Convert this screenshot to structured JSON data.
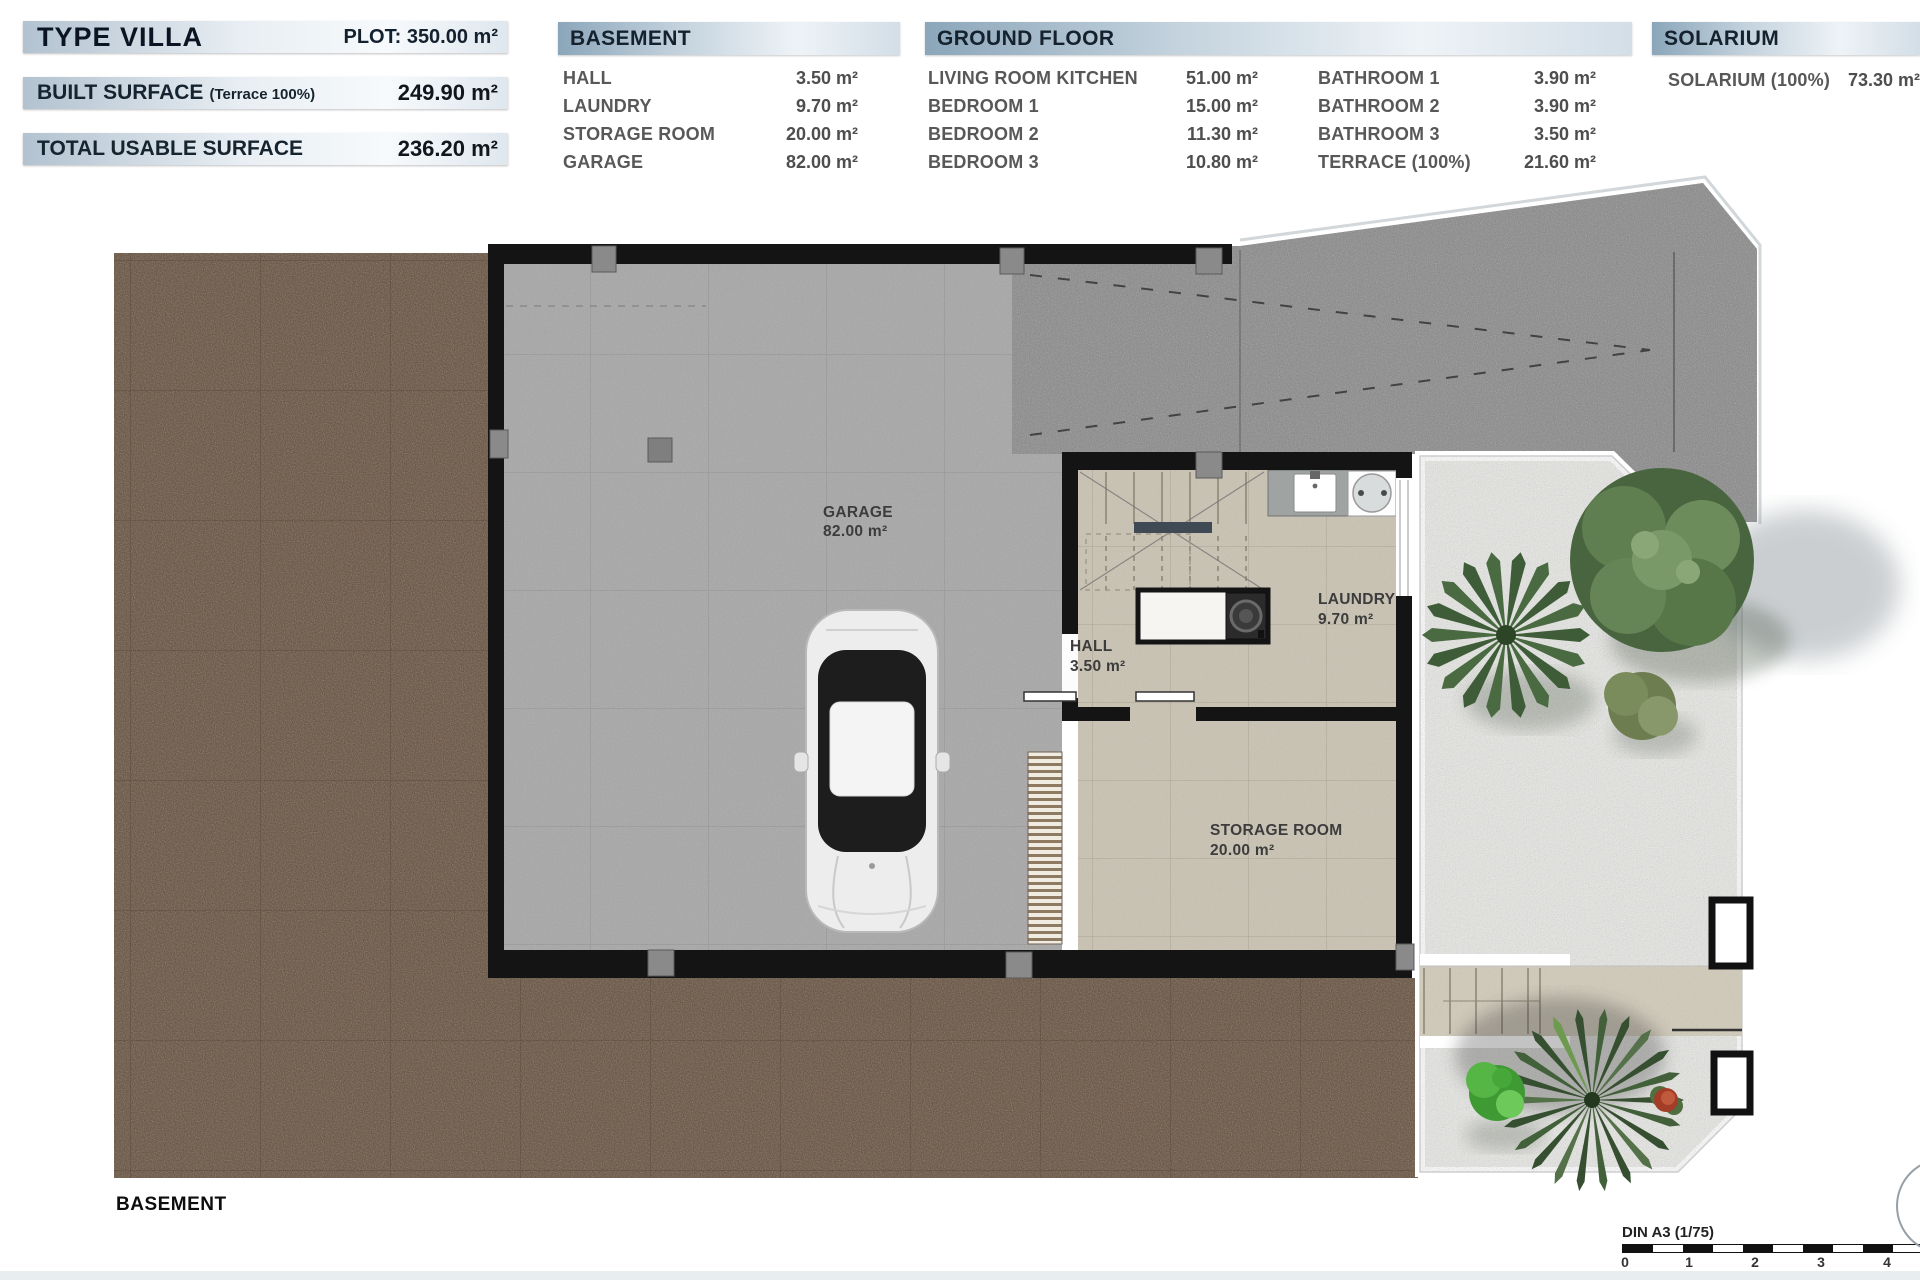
{
  "summary": {
    "type_label": "TYPE VILLA",
    "plot_label": "PLOT: 350.00 m²",
    "built_surface_label": "BUILT SURFACE",
    "built_surface_note": "(Terrace 100%)",
    "built_surface_value": "249.90 m²",
    "total_usable_label": "TOTAL USABLE SURFACE",
    "total_usable_value": "236.20 m²"
  },
  "tables": {
    "basement": {
      "title": "BASEMENT",
      "rows": [
        {
          "label": "HALL",
          "value": "3.50 m²"
        },
        {
          "label": "LAUNDRY",
          "value": "9.70 m²"
        },
        {
          "label": "STORAGE ROOM",
          "value": "20.00 m²"
        },
        {
          "label": "GARAGE",
          "value": "82.00 m²"
        }
      ]
    },
    "ground_floor": {
      "title": "GROUND FLOOR",
      "left_rows": [
        {
          "label": "LIVING ROOM KITCHEN",
          "value": "51.00 m²"
        },
        {
          "label": "BEDROOM 1",
          "value": "15.00 m²"
        },
        {
          "label": "BEDROOM 2",
          "value": "11.30 m²"
        },
        {
          "label": "BEDROOM 3",
          "value": "10.80 m²"
        }
      ],
      "right_rows": [
        {
          "label": "BATHROOM 1",
          "value": "3.90 m²"
        },
        {
          "label": "BATHROOM 2",
          "value": "3.90 m²"
        },
        {
          "label": "BATHROOM 3",
          "value": "3.50 m²"
        },
        {
          "label": "TERRACE (100%)",
          "value": "21.60 m²"
        }
      ]
    },
    "solarium": {
      "title": "SOLARIUM",
      "rows": [
        {
          "label": "SOLARIUM (100%)",
          "value": "73.30 m²"
        }
      ]
    }
  },
  "plan": {
    "floor_label": "BASEMENT",
    "rooms": [
      {
        "name": "GARAGE",
        "area": "82.00 m²"
      },
      {
        "name": "HALL",
        "area": "3.50 m²"
      },
      {
        "name": "LAUNDRY",
        "area": "9.70 m²"
      },
      {
        "name": "STORAGE ROOM",
        "area": "20.00 m²"
      }
    ]
  },
  "scale_bar": {
    "label": "DIN A3 (1/75)",
    "ticks": [
      "0",
      "1",
      "2",
      "3",
      "4"
    ]
  },
  "colors": {
    "header_dark": "#8ba6ba",
    "header_light": "#eef3f7",
    "bar_light": "#b2c2d0",
    "dirt": "#5f4833",
    "asphalt": "#868686",
    "gravel": "#e9e9e6",
    "concrete": "#a7a7a7",
    "tile": "#cac3b3",
    "wall": "#141414"
  }
}
